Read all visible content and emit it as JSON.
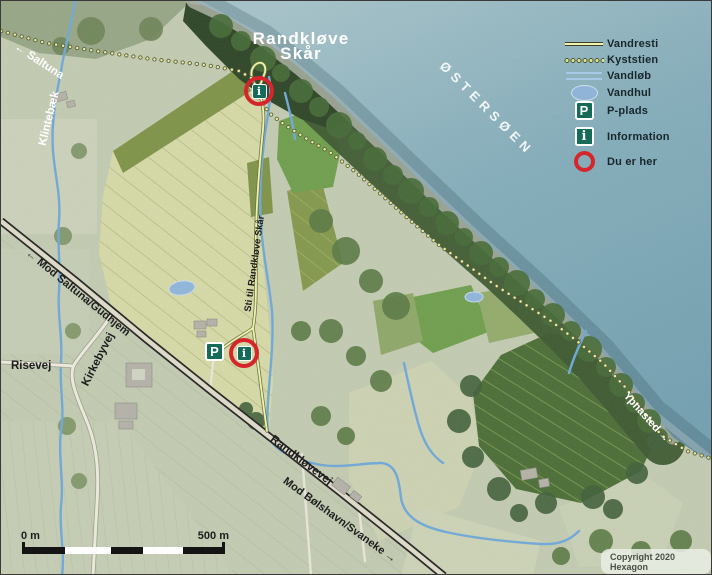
{
  "title": {
    "line1": "Randkløve",
    "line2": "Skår"
  },
  "sea": {
    "label": "ØSTERSØEN"
  },
  "legend": {
    "items": [
      {
        "label": "Vandresti"
      },
      {
        "label": "Kyststien"
      },
      {
        "label": "Vandløb"
      },
      {
        "label": "Vandhul"
      },
      {
        "label": "P-plads"
      },
      {
        "label": "Information"
      },
      {
        "label": "Du er her"
      }
    ]
  },
  "labels": {
    "saltuna": "Saltuna",
    "klintebaek": "Klintebæk",
    "risevej": "Risevej",
    "kirkebyvej": "Kirkebyvej",
    "mod_saltuna_gudhjem": "Mod Saltuna/Gudhjem",
    "randklovevej": "Randkløvevej",
    "mod_bolshavn_svaneke": "Mod Bølshavn/Svaneke",
    "sti_til_randklove_skar": "Sti til Randkløve Skår",
    "ypnasted": "Ypnasted"
  },
  "icons": {
    "parking_glyph": "P",
    "info_glyph": "i",
    "arrow_left": "←",
    "arrow_right": "→"
  },
  "scalebar": {
    "start": "0 m",
    "end": "500 m"
  },
  "copyright": "Copyright 2020 Hexagon",
  "colors": {
    "sea": "#7fa9b6",
    "bright_field": "#d6d9a6",
    "woodland": "#3d5a31",
    "dark_field": "#4b6d36",
    "stream": "#6fa8d8",
    "trail": "#eef4a8",
    "marker_red": "#d6252b",
    "icon_green": "#156a58"
  }
}
